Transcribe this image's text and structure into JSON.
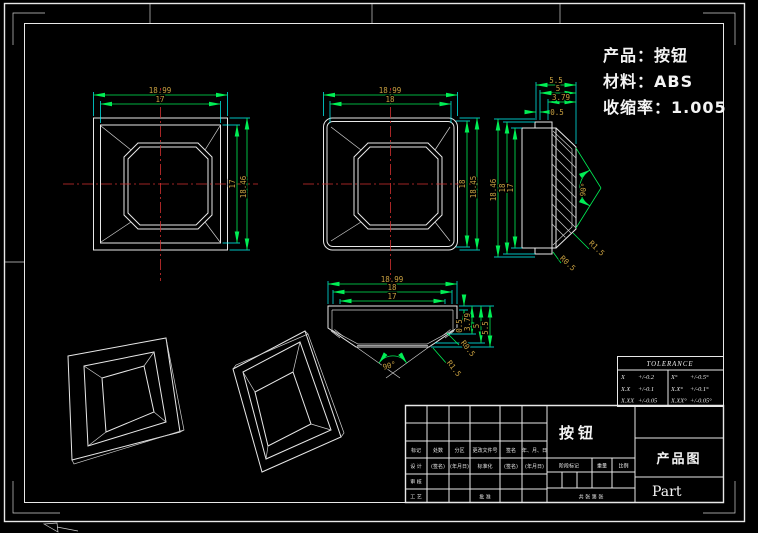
{
  "info_block": {
    "product": "产品：按钮",
    "material": "材料：ABS",
    "shrinkage": "收缩率：1.005"
  },
  "views": {
    "top_view": {
      "w_outer": "18.99",
      "w_inner": "17",
      "h_inner": "17",
      "h_outer": "18.46"
    },
    "bottom_view": {
      "w_outer": "18.99",
      "w_inner": "18",
      "h_inner": "18",
      "h_outer": "18.45"
    },
    "side_view": {
      "w1": "5.5",
      "w2": "5",
      "w3": "3.79",
      "w4": "0.5",
      "h1": "18.46",
      "h2": "18",
      "h3": "17",
      "angle": "90°",
      "r1": "R1.5",
      "r2": "R0.5"
    },
    "section_view": {
      "w1": "18.99",
      "w2": "18",
      "w3": "17",
      "v1": "0.5",
      "v2": "3.79",
      "v3": "5",
      "v4": "5.5",
      "angle": "90°",
      "r1": "R1.5",
      "r2": "R0.5"
    }
  },
  "tolerance_table": {
    "title": "TOLERANCE",
    "rows": [
      {
        "c1": "X",
        "v1": "+/-0.2",
        "c2": "X°",
        "v2": "+/-0.5°"
      },
      {
        "c1": "X.X",
        "v1": "+/-0.1",
        "c2": "X.X°",
        "v2": "+/-0.1°"
      },
      {
        "c1": "X.XX",
        "v1": "+/-0.05",
        "c2": "X.XX°",
        "v2": "+/-0.05°"
      }
    ]
  },
  "title_block": {
    "name": "按钮",
    "drawing_type": "产品图",
    "part_code": "Part",
    "header_row": [
      "标记",
      "处数",
      "分区",
      "更改文件号",
      "签名",
      "年、月、日"
    ],
    "design_row": [
      "设 计",
      "(签名)",
      "(年月日)",
      "标准化",
      "(签名)",
      "(年月日)"
    ],
    "audit": "审 核",
    "process": "工 艺",
    "approve": "批 准",
    "stage_label": "阶段标记",
    "weight_label": "重量",
    "scale_label": "比例",
    "sheet_label": "共  张  第  张"
  }
}
